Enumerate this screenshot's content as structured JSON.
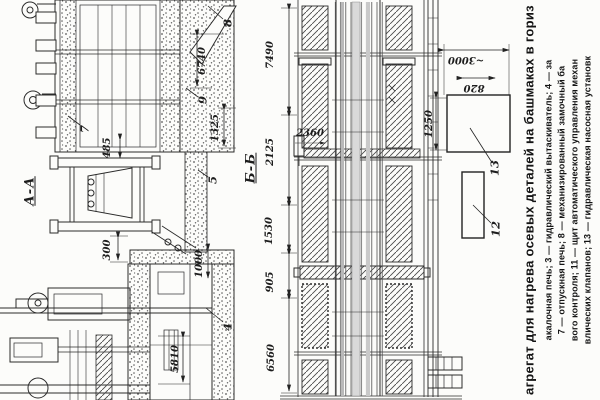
{
  "section_labels": {
    "aa": "А-А",
    "bb": "Б-Б"
  },
  "dimensions": {
    "d6740": "6740",
    "d485": "485",
    "d1325": "1325",
    "d300": "300",
    "d1000": "1000",
    "d5810": "5810",
    "d7490": "7490",
    "d2125": "2125",
    "d1530": "1530",
    "d905": "905",
    "d6560": "6560",
    "d2360": "2360",
    "d1250": "1250",
    "d820": "820",
    "d3000": "~3000"
  },
  "callouts": {
    "c4": "4",
    "c5": "5",
    "c7": "7",
    "c8": "8",
    "c9": "9",
    "c12": "12",
    "c13": "13"
  },
  "caption": {
    "title": "агрегат для нагрева осевых деталей на башмаках в гориз",
    "line1": "акалочная печь; 3 — гидравлический вытаскиватель; 4 — за",
    "line2": "7 — отпускная печь; 8 — механизированный замочный ба",
    "line3": "вого контроля; 11 — щит автоматического управления механ",
    "line4": "влических клапанов; 13 — гидравлическая насосная установк"
  }
}
